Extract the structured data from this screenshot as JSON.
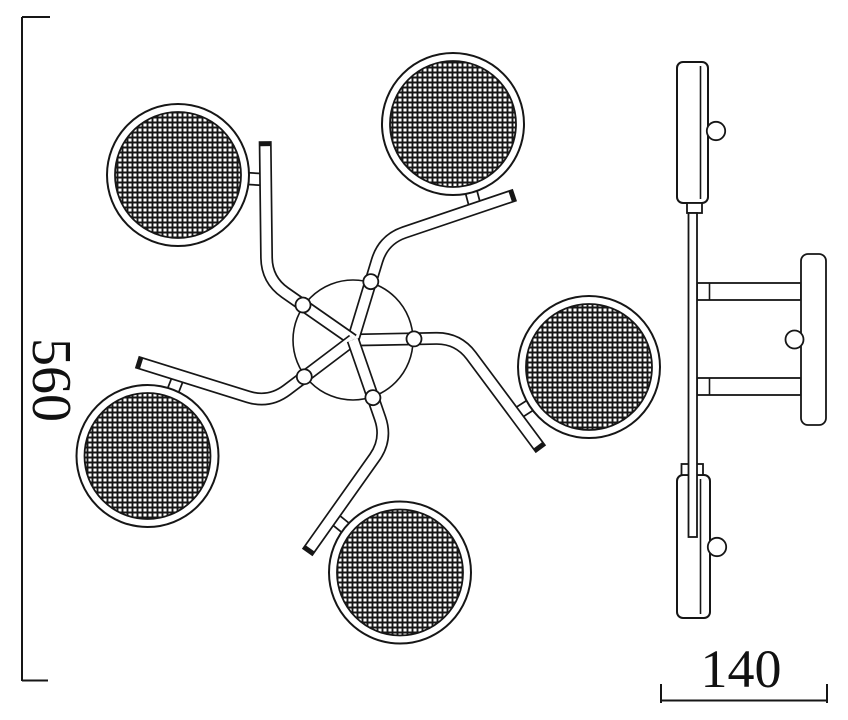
{
  "drawing": {
    "height_dimension": "560",
    "width_dimension": "140"
  }
}
